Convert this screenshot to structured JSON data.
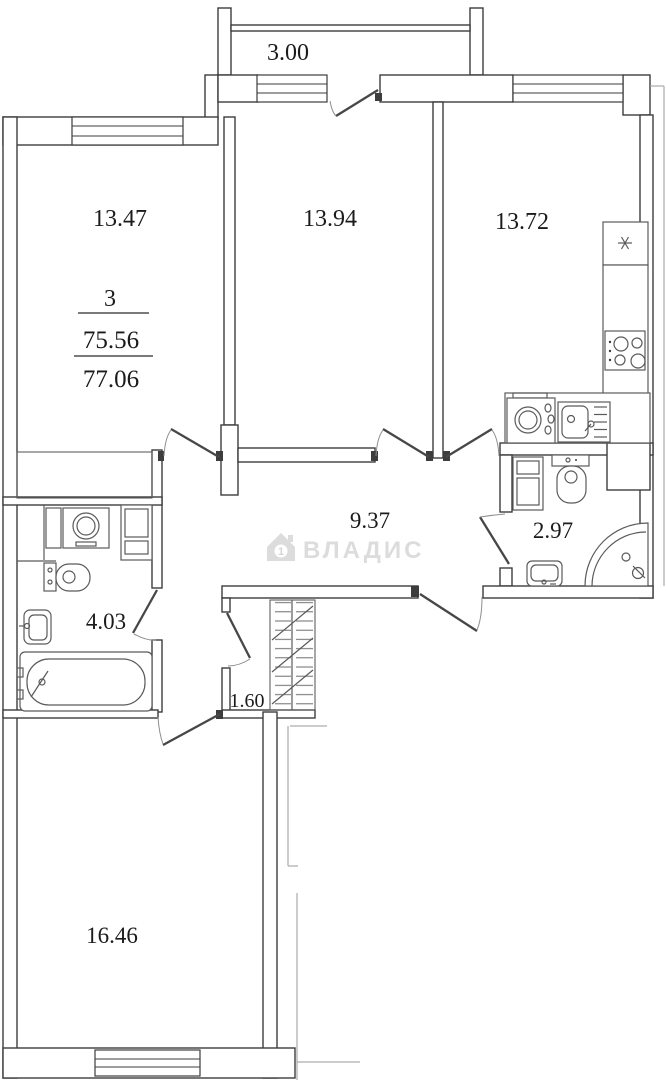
{
  "plan": {
    "title_block": {
      "rooms_count": "3",
      "living_area": "75.56",
      "total_area": "77.06"
    },
    "room_labels": {
      "balcony": "3.00",
      "bedroom_left": "13.47",
      "bedroom_middle": "13.94",
      "kitchen": "13.72",
      "hallway": "9.37",
      "bathroom_right": "2.97",
      "bathroom_left": "4.03",
      "closet": "1.60",
      "living_room": "16.46"
    },
    "watermark": {
      "brand": "ВЛАДИС",
      "icon_number": "1"
    },
    "colors": {
      "wall_line": "#3d3d3d",
      "fixture_line": "#5a5a5a",
      "thin_line": "#9a9a9a",
      "label_text": "#1b1b1b",
      "watermark_gray": "#dcdcdc",
      "background": "#ffffff"
    }
  }
}
